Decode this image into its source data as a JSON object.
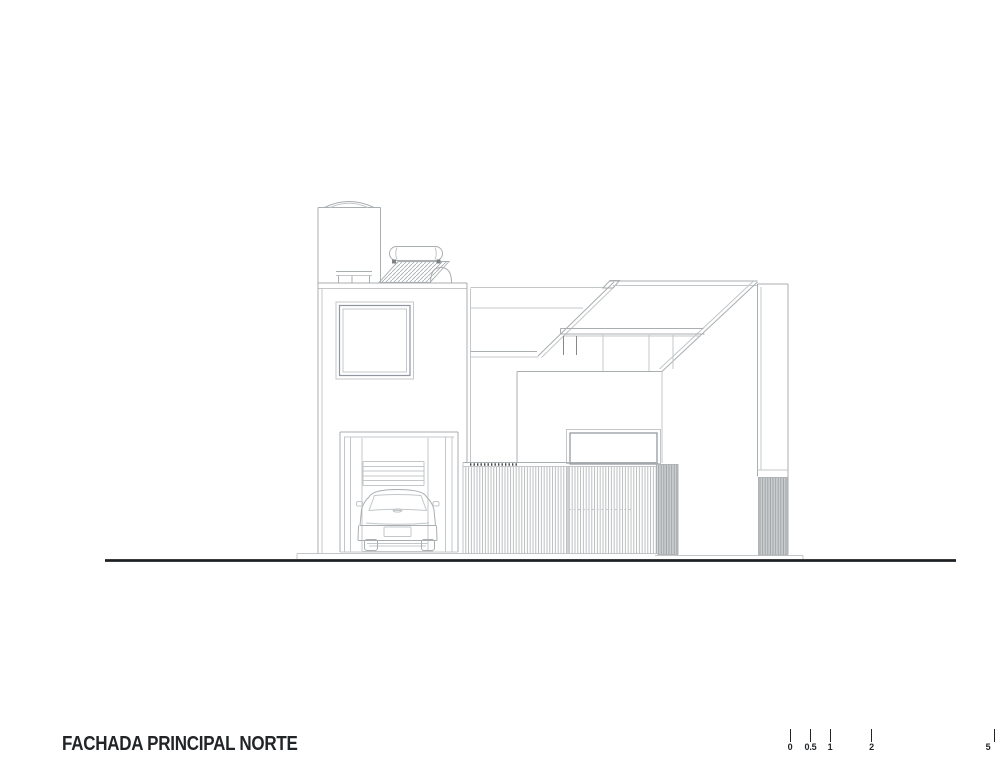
{
  "title": {
    "text": "FACHADA PRINCIPAL NORTE"
  },
  "scale_bar": {
    "unit_labels": [
      "0",
      "0.5",
      "1",
      "2",
      "5"
    ]
  },
  "drawing": {
    "name": "north-facade-elevation",
    "elements": [
      "ground-line",
      "left-volume",
      "parapet",
      "square-window",
      "water-tank",
      "solar-water-heater",
      "roof-equipment-table",
      "garage-opening",
      "car-rear-view",
      "garage-door-louvers",
      "sloped-roof",
      "clerestory-mullions",
      "lower-volume",
      "patio-window",
      "slatted-fence",
      "grey-slat-panel-left",
      "grey-slat-panel-right",
      "right-pier"
    ]
  },
  "colors": {
    "line_light": "#c3c7c9",
    "line_mid": "#a9aeb1",
    "line_dark": "#85898c",
    "line_accent": "#45494b",
    "fill_grey": "#cacdce",
    "ground": "#1e2123",
    "text": "#222527",
    "paper": "#ffffff"
  }
}
